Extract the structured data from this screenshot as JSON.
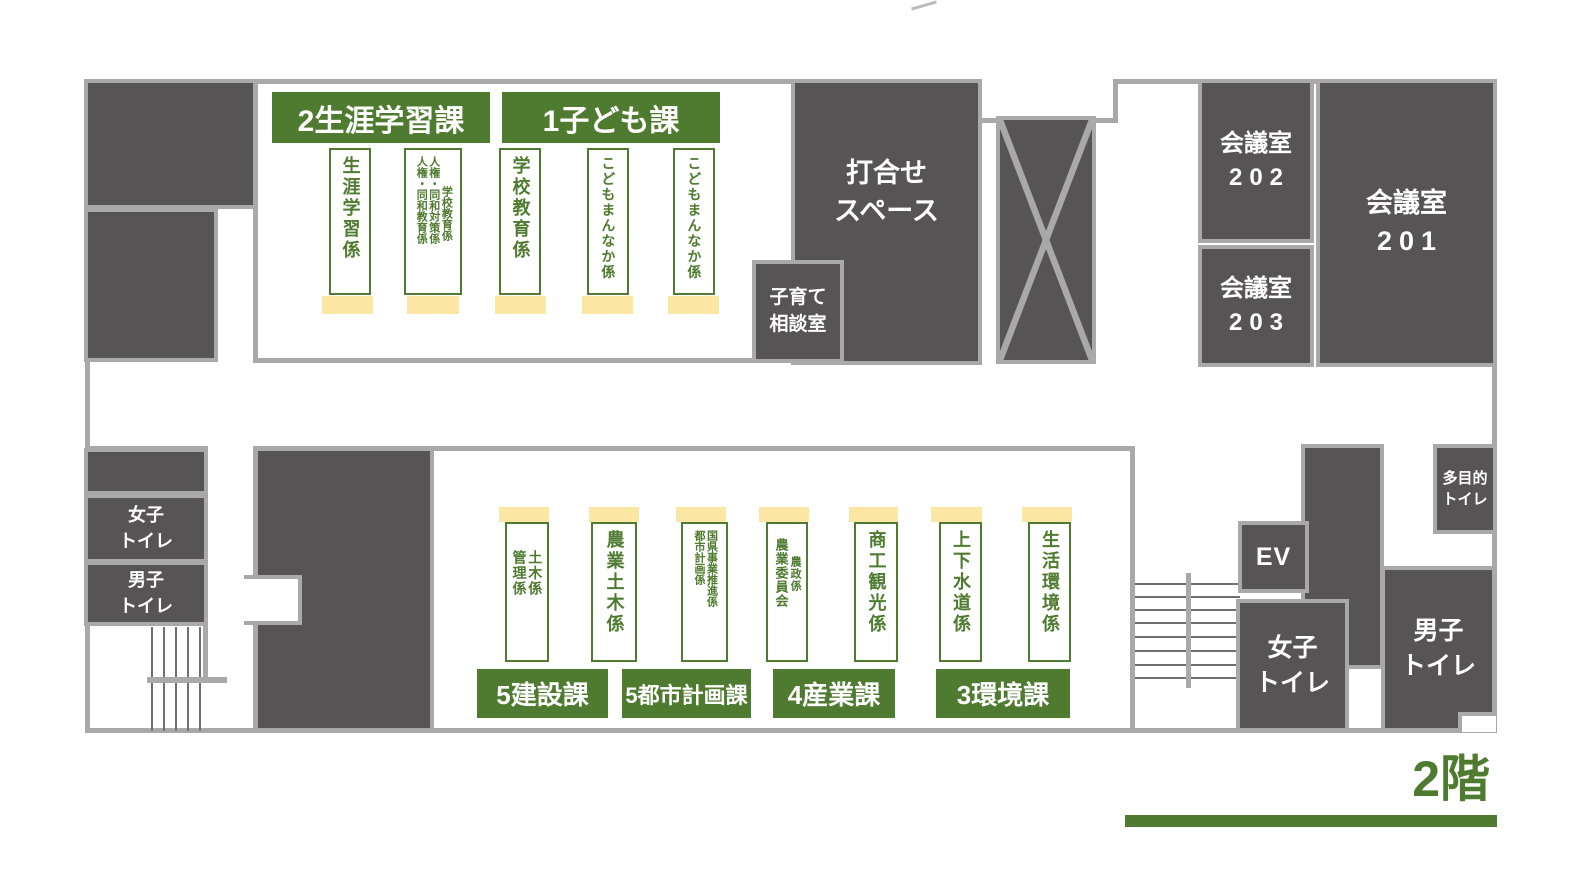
{
  "floor_label": "2階",
  "colors": {
    "accent_green": "#4e7b2f",
    "room_dark": "#575456",
    "wall_gray": "#a9a9a9",
    "desk_base_yellow": "#fce6a4"
  },
  "top": {
    "headers": [
      {
        "label": "2生涯学習課"
      },
      {
        "label": "1子ども課"
      }
    ],
    "desks": [
      {
        "columns": [
          "生涯学習係"
        ]
      },
      {
        "columns": [
          "学校教育係",
          "人権・同和対策係",
          "人権・同和教育係"
        ]
      },
      {
        "columns": [
          "学校教育係"
        ]
      },
      {
        "columns": [
          "こどもまんなか係"
        ]
      },
      {
        "columns": [
          "こどもまんなか係"
        ]
      }
    ],
    "meeting_space": {
      "line1": "打合せ",
      "line2": "スペース"
    },
    "kosodate_room": {
      "line1": "子育て",
      "line2": "相談室"
    },
    "conf202": {
      "line1": "会議室",
      "line2": "202"
    },
    "conf203": {
      "line1": "会議室",
      "line2": "203"
    },
    "conf201": {
      "line1": "会議室",
      "line2": "201"
    }
  },
  "bottom": {
    "headers": [
      {
        "label": "5建設課"
      },
      {
        "label": "5都市計画課"
      },
      {
        "label": "4産業課"
      },
      {
        "label": "3環境課"
      }
    ],
    "desks": [
      {
        "columns": [
          "土木係",
          "管理係"
        ]
      },
      {
        "columns": [
          "農業土木係"
        ]
      },
      {
        "columns": [
          "国県事業推進係",
          "都市計画係"
        ]
      },
      {
        "columns": [
          "農政係",
          "農業委員会"
        ]
      },
      {
        "columns": [
          "商工観光係"
        ]
      },
      {
        "columns": [
          "上下水道係"
        ]
      },
      {
        "columns": [
          "生活環境係"
        ]
      }
    ],
    "women_toilet_left": {
      "line1": "女子",
      "line2": "トイレ"
    },
    "men_toilet_left": {
      "line1": "男子",
      "line2": "トイレ"
    },
    "elevator": {
      "label": "EV"
    },
    "women_toilet_right": {
      "line1": "女子",
      "line2": "トイレ"
    },
    "men_toilet_right": {
      "line1": "男子",
      "line2": "トイレ"
    },
    "multipurpose_toilet": {
      "line1": "多目的",
      "line2": "トイレ"
    }
  }
}
